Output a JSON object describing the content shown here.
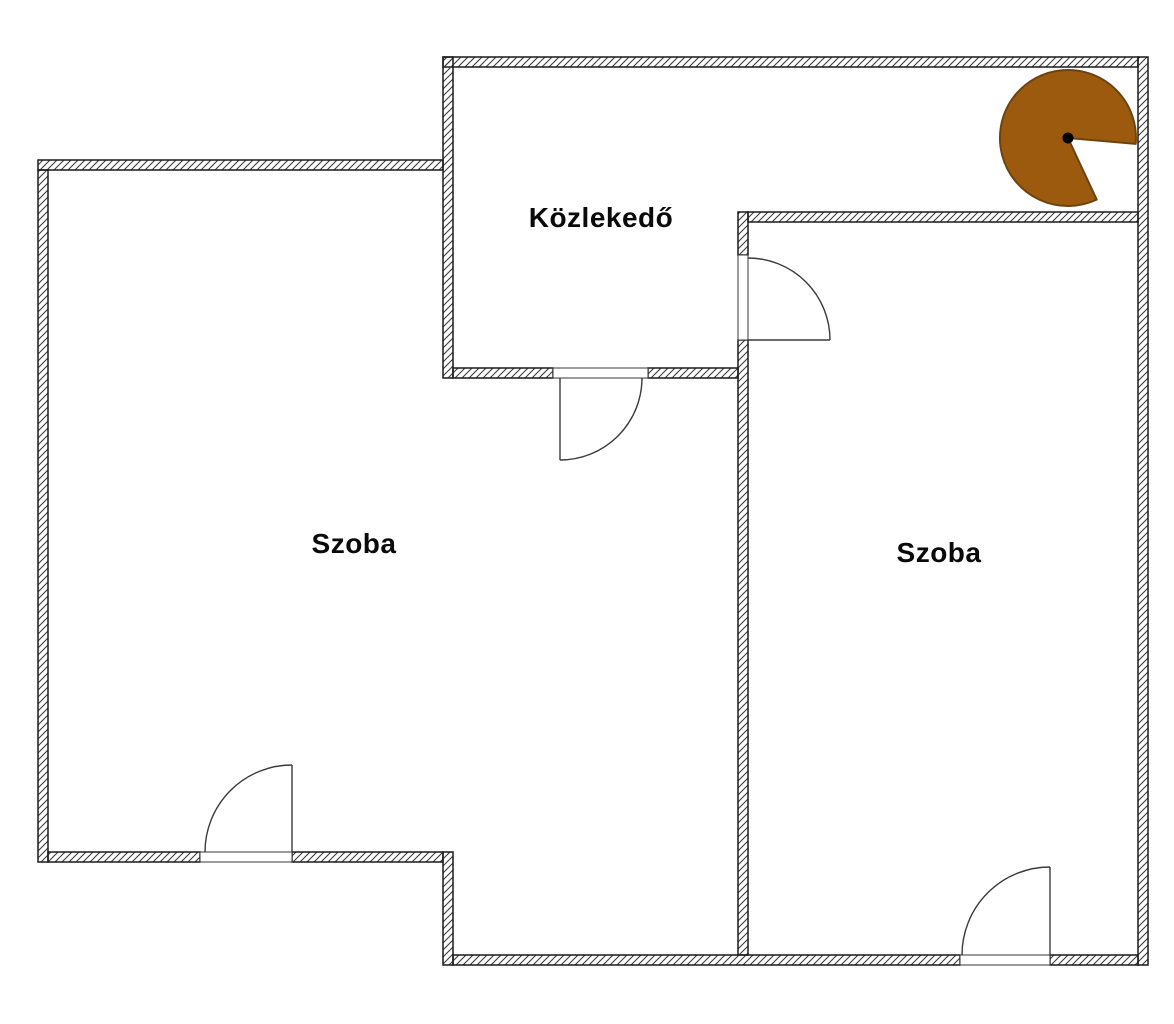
{
  "rooms": {
    "hallway": {
      "label": "Közlekedő"
    },
    "left_room": {
      "label": "Szoba"
    },
    "right_room": {
      "label": "Szoba"
    }
  },
  "viewpoint_marker": {
    "fill": "#9B5A0E",
    "stroke": "#6D4410",
    "dot_color": "#000000",
    "sweep_degrees": 300
  },
  "drawing": {
    "wall_outline_color": "#1a1a1a",
    "hatch_line_color": "#3c3c3c",
    "door_line_color": "#3a3a3a",
    "background_color": "#ffffff"
  }
}
